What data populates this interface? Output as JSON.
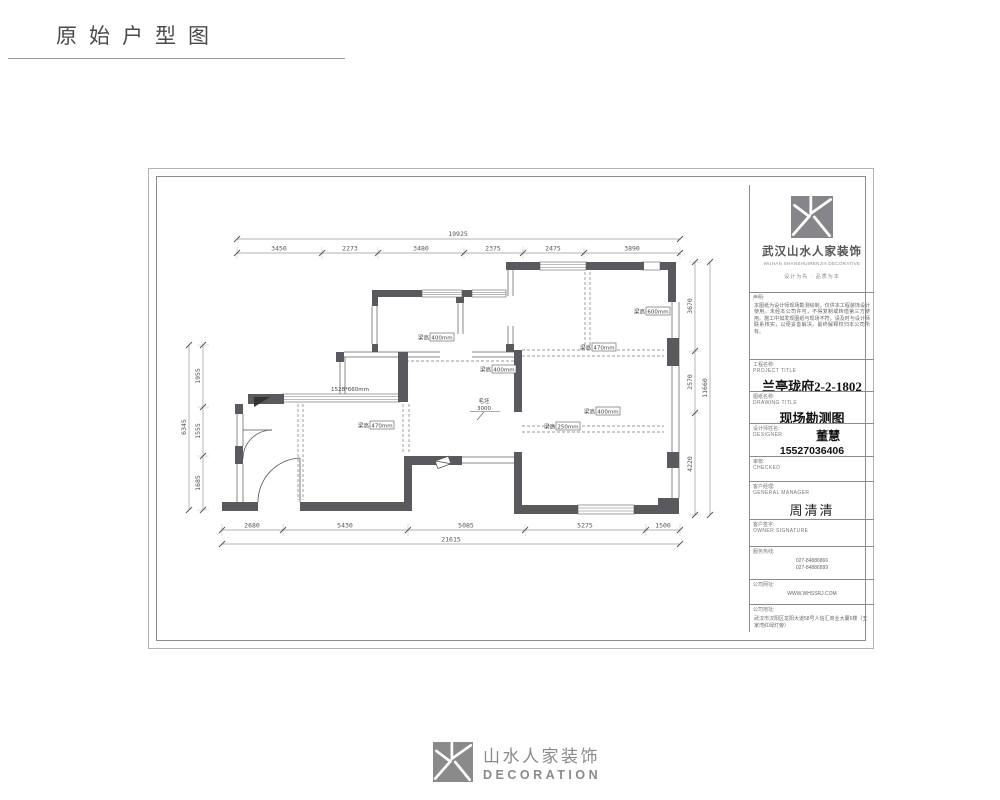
{
  "page": {
    "title": "原始户型图"
  },
  "footer": {
    "cn": "山水人家装饰",
    "en": "DECORATION"
  },
  "titleblock": {
    "company": {
      "cn": "武汉山水人家装饰",
      "en": "WUHAN SHANSHUIRENJIA DECORATIVE",
      "tagline": "设计为先 · 品质为本"
    },
    "declaration": {
      "label": "声明:",
      "text": "本图纸为设计师现场勘测绘制，仅供本工程装饰设计使用。未经本公司许可，不得复制或转借第三方使用。施工中如发现图纸与现场不符，请及时与设计师联系核实，以便妥善解决。最终解释权归本公司所有。"
    },
    "project": {
      "label_cn": "工程名称:",
      "label_en": "PROJECT TITLE",
      "value": "兰亭珑府2-2-1802"
    },
    "drawing": {
      "label_cn": "图纸名称:",
      "label_en": "DRAWING TITLE",
      "value": "现场勘测图"
    },
    "designer": {
      "label_cn": "设计师姓名:",
      "label_en": "DESIGNER",
      "name": "董慧",
      "phone": "15527036406"
    },
    "checker": {
      "label_cn": "审核:",
      "label_en": "CHECKED"
    },
    "manager": {
      "label_cn": "客户经理:",
      "label_en": "GENERAL MANAGER",
      "name": "周清清"
    },
    "owner": {
      "label_cn": "客户签字:",
      "label_en": "OWNER SIGNATURE"
    },
    "hotline": {
      "label": "服务热线:",
      "line1": "027-84886866",
      "line2": "027-84886899"
    },
    "website": {
      "label": "公司网址:",
      "value": "WWW.WHSSRJ.COM"
    },
    "address": {
      "label": "公司地址:",
      "text": "武汉市汉阳区龙阳大道58号人信汇商业大厦6楼（王家湾红绿灯旁）"
    }
  },
  "plan": {
    "dims": {
      "top_total": "19925",
      "top_segments": [
        "3450",
        "2273",
        "3480",
        "2375",
        "2475",
        "3890"
      ],
      "bottom_segments": [
        "2680",
        "5430",
        "5085",
        "5275",
        "1500"
      ],
      "bottom_total": "21615",
      "left_segments": [
        "1955",
        "1555",
        "1685"
      ],
      "left_total": "6345",
      "right_segments": [
        "3670",
        "2570",
        "4220"
      ],
      "right_total": "11660"
    },
    "beams": [
      {
        "prefix": "梁高",
        "value": "400mm"
      },
      {
        "prefix": "梁高",
        "value": "470mm"
      },
      {
        "prefix": "梁高",
        "value": "400mm"
      },
      {
        "prefix": "梁高",
        "value": "600mm"
      },
      {
        "prefix": "梁高",
        "value": "400mm"
      },
      {
        "prefix": "梁高",
        "value": "250mm"
      },
      {
        "prefix": "梁高",
        "value": "470mm"
      }
    ],
    "window_note": "1528*660mm",
    "rough_note": {
      "line1": "毛坯",
      "line2": "3000"
    }
  }
}
